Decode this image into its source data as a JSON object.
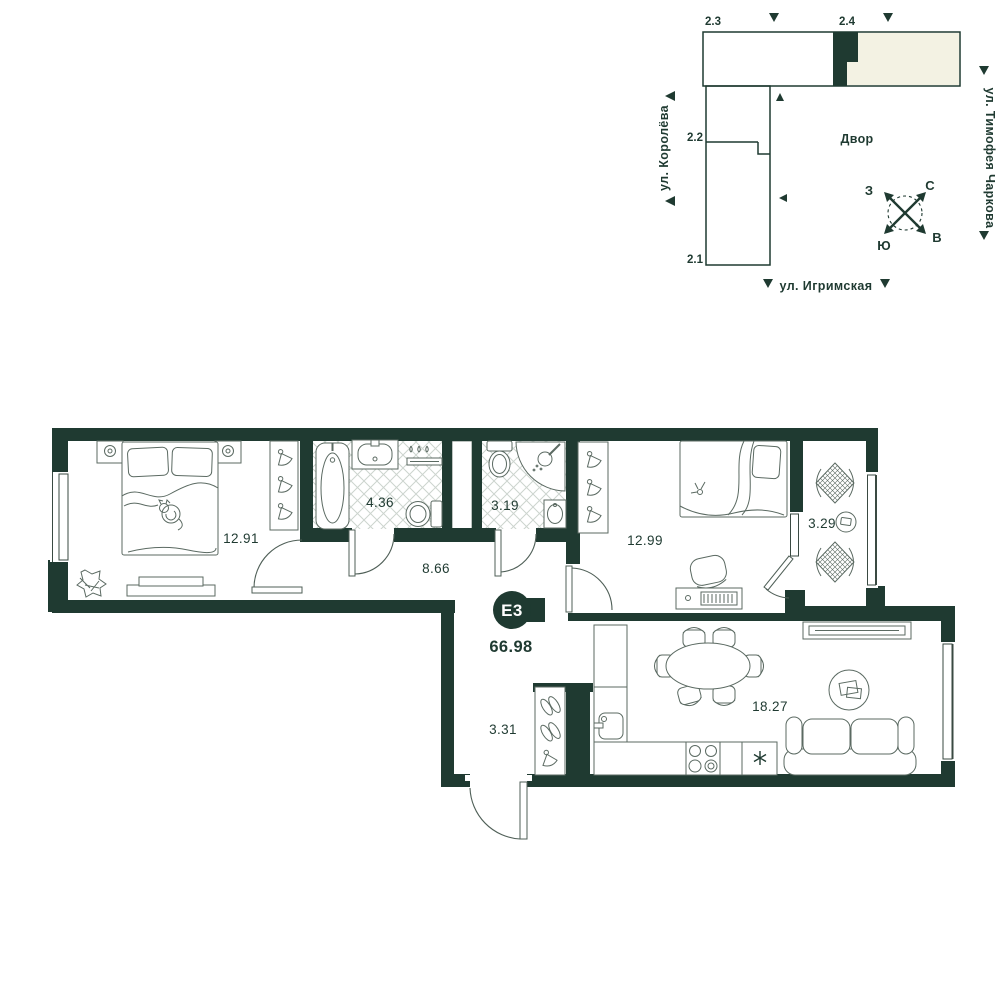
{
  "site_plan": {
    "blocks": [
      {
        "label": "2.3"
      },
      {
        "label": "2.4"
      },
      {
        "label": "2.2"
      },
      {
        "label": "2.1"
      }
    ],
    "courtyard_label": "Двор",
    "streets": {
      "left": "ул. Королёва",
      "right": "ул. Тимофея Чаркова",
      "bottom": "ул. Игримская"
    },
    "compass": {
      "north": "С",
      "south": "Ю",
      "west": "З",
      "east": "В"
    }
  },
  "apartment": {
    "unit_badge": "E3",
    "total_area": "66.98",
    "rooms": [
      {
        "name": "bedroom-1",
        "area": "12.91"
      },
      {
        "name": "bathroom",
        "area": "4.36"
      },
      {
        "name": "wc",
        "area": "3.19"
      },
      {
        "name": "hallway",
        "area": "8.66"
      },
      {
        "name": "bedroom-2",
        "area": "12.99"
      },
      {
        "name": "loggia",
        "area": "3.29"
      },
      {
        "name": "entry-hall",
        "area": "3.31"
      },
      {
        "name": "kitchen-living",
        "area": "18.27"
      }
    ]
  },
  "colors": {
    "wall": "#1f3a31",
    "highlight_fill": "#f3f2e3",
    "furniture_line": "#5b6a62",
    "tile_line": "#ccd4ce"
  }
}
